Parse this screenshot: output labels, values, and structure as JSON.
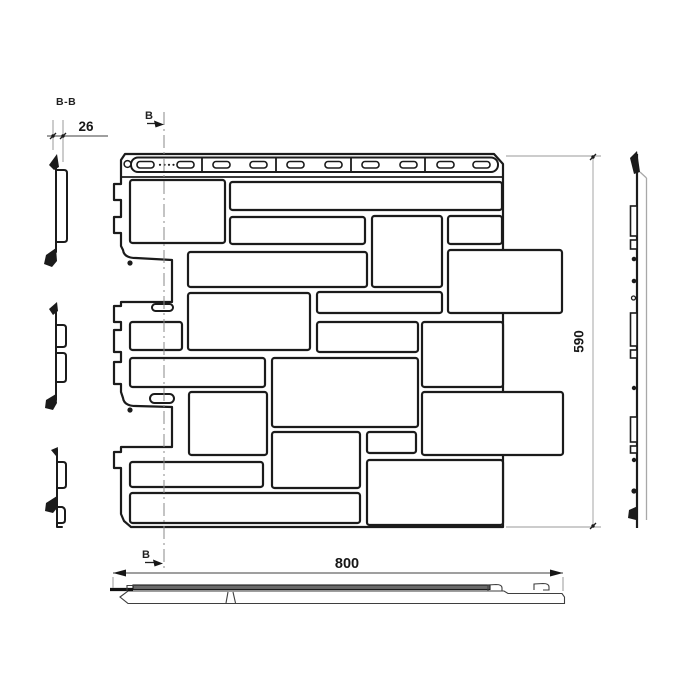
{
  "meta": {
    "background_color": "#ffffff",
    "line_color": "#1b1b1b",
    "dim_color": "#3f3f3f",
    "light_color": "#a8a8a8",
    "shade_color": "#6a6a6a"
  },
  "labels": {
    "section_title": "B-B",
    "section_mark_top": "B",
    "section_mark_bottom": "B"
  },
  "dimensions": {
    "panel_width": "800",
    "panel_height": "590",
    "panel_thickness": "26"
  },
  "front_view": {
    "blocks": [
      [
        130,
        180,
        95,
        63
      ],
      [
        230,
        182,
        272,
        28
      ],
      [
        230,
        217,
        135,
        27
      ],
      [
        372,
        216,
        70,
        71
      ],
      [
        448,
        216,
        54,
        28
      ],
      [
        188,
        252,
        179,
        35
      ],
      [
        448,
        250,
        114,
        63
      ],
      [
        188,
        293,
        122,
        57
      ],
      [
        317,
        292,
        125,
        21
      ],
      [
        130,
        322,
        52,
        28
      ],
      [
        317,
        322,
        101,
        30
      ],
      [
        422,
        322,
        81,
        65
      ],
      [
        130,
        358,
        135,
        29
      ],
      [
        272,
        358,
        146,
        69
      ],
      [
        189,
        392,
        78,
        63
      ],
      [
        422,
        392,
        141,
        63
      ],
      [
        272,
        432,
        88,
        56
      ],
      [
        367,
        432,
        49,
        21
      ],
      [
        130,
        462,
        133,
        25
      ],
      [
        367,
        460,
        136,
        65
      ],
      [
        130,
        493,
        230,
        30
      ]
    ],
    "nail_slots_x": [
      137,
      177,
      213,
      250,
      287,
      325,
      362,
      400,
      437,
      473
    ],
    "nail_slot": {
      "y": 161.5,
      "w": 17,
      "h": 6.5,
      "r": 3
    },
    "nail_dots_x": [
      160,
      164.5,
      169,
      173.5
    ],
    "nail_dots_y": 164.8,
    "strip_dividers_x": [
      202,
      276,
      351,
      425
    ],
    "face_ovals": [
      [
        152,
        304,
        21,
        7
      ],
      [
        150,
        394,
        24,
        9
      ]
    ]
  }
}
